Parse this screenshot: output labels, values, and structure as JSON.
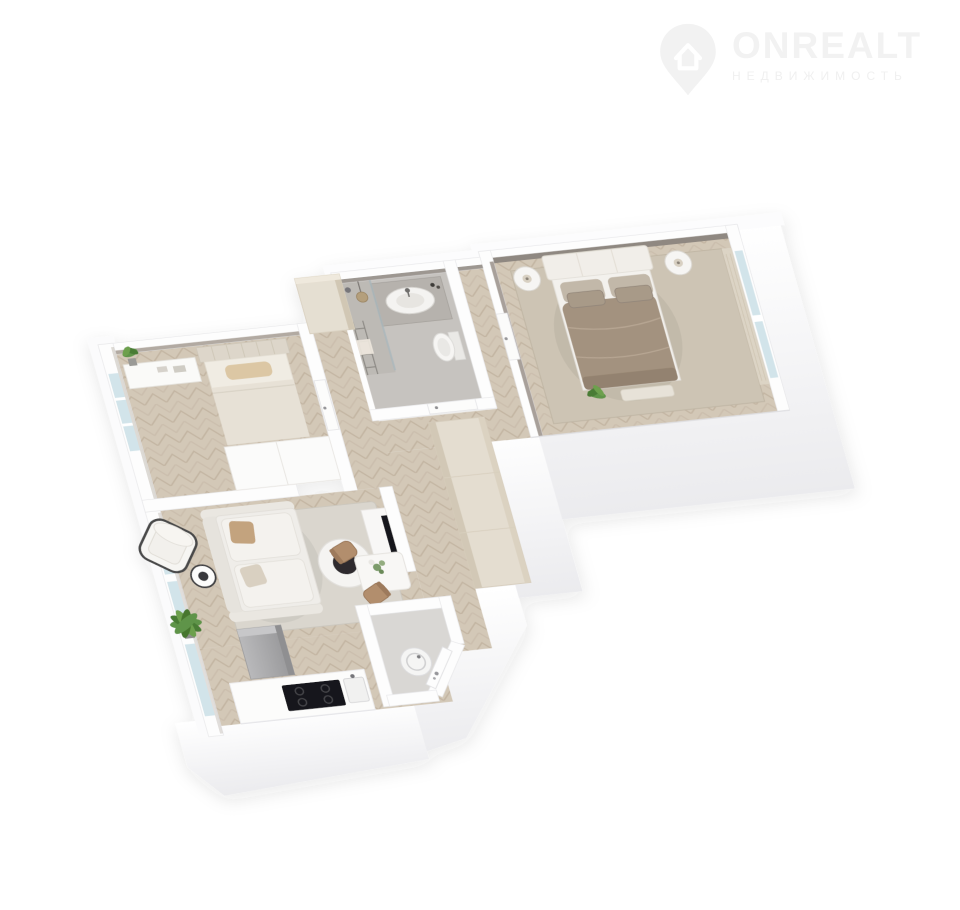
{
  "page": {
    "width": 960,
    "height": 910,
    "background": "#ffffff"
  },
  "watermark": {
    "brand": "ONREALT",
    "subtitle": "НЕДВИЖИМОСТЬ",
    "icon": "house-pin-icon",
    "brand_color": "#f2f2f2",
    "subtitle_color": "#f0f0f0"
  },
  "floorplan": {
    "view": "3d-axonometric-apartment-render",
    "palette": {
      "wall_white": "#fdfdfd",
      "wall_shade": "#ededf0",
      "wall_inner_taupe": "#8f8881",
      "wall_inner_light": "#b2aaa2",
      "floor_wood": "#d3c8b7",
      "floor_bath": "#c6c3bf",
      "floor_wc": "#d9d7d4",
      "rug_master": "#cdc4b4",
      "rug_living": "#dad6ce",
      "duvet_taupe": "#a3927f",
      "pillow_back": "#c2b8a9",
      "pillow_front": "#a89a88",
      "headboard_white": "#f1eee9",
      "bed2_duvet": "#e7e1d6",
      "pillow_beige": "#dcc7a4",
      "glass_blue": "#d2e4ea",
      "curtain_beige": "#ddd5c6",
      "wardrobe_cream": "#e4ddd0",
      "wardrobe_front": "#d2c8b6",
      "sofa_white": "#efede9",
      "chair_brown": "#b28e6d",
      "plant_green": "#5f9449",
      "appliance_black": "#17171a",
      "fridge_gray": "#a7a7a9",
      "table_white": "#f8f7f5"
    },
    "rooms": [
      {
        "id": "bedroom-secondary",
        "furniture": [
          "bed-tufted-headboard",
          "beige-pillow",
          "desk-console",
          "potted-plant",
          "white-wardrobe",
          "window",
          "door"
        ]
      },
      {
        "id": "bathroom",
        "furniture": [
          "vanity-counter",
          "round-basin",
          "faucet",
          "bottles",
          "toilet",
          "shower-glass",
          "towel-ladder",
          "pendant-lamp",
          "tall-cabinet",
          "door"
        ]
      },
      {
        "id": "bedroom-master",
        "furniture": [
          "double-bed",
          "white-headboard",
          "taupe-duvet",
          "pillows",
          "nightstand-left",
          "nightstand-right",
          "table-lamps",
          "rug",
          "bench",
          "plant",
          "window",
          "curtain",
          "door"
        ]
      },
      {
        "id": "living-room",
        "furniture": [
          "sofa",
          "accent-pillows",
          "coffee-table-round",
          "black-tray",
          "armchair-black-frame",
          "wire-side-table",
          "palm-plant",
          "tv",
          "tv-console",
          "rug",
          "windows"
        ]
      },
      {
        "id": "kitchen",
        "furniture": [
          "counter",
          "cooktop",
          "sink",
          "fridge-column"
        ]
      },
      {
        "id": "dining-nook",
        "furniture": [
          "table-with-flowers",
          "chair-brown-1",
          "chair-brown-2"
        ]
      },
      {
        "id": "wc-laundry",
        "furniture": [
          "washing-machine"
        ]
      },
      {
        "id": "hallway",
        "furniture": [
          "cream-wardrobe",
          "entrance-door",
          "landing"
        ]
      }
    ]
  }
}
